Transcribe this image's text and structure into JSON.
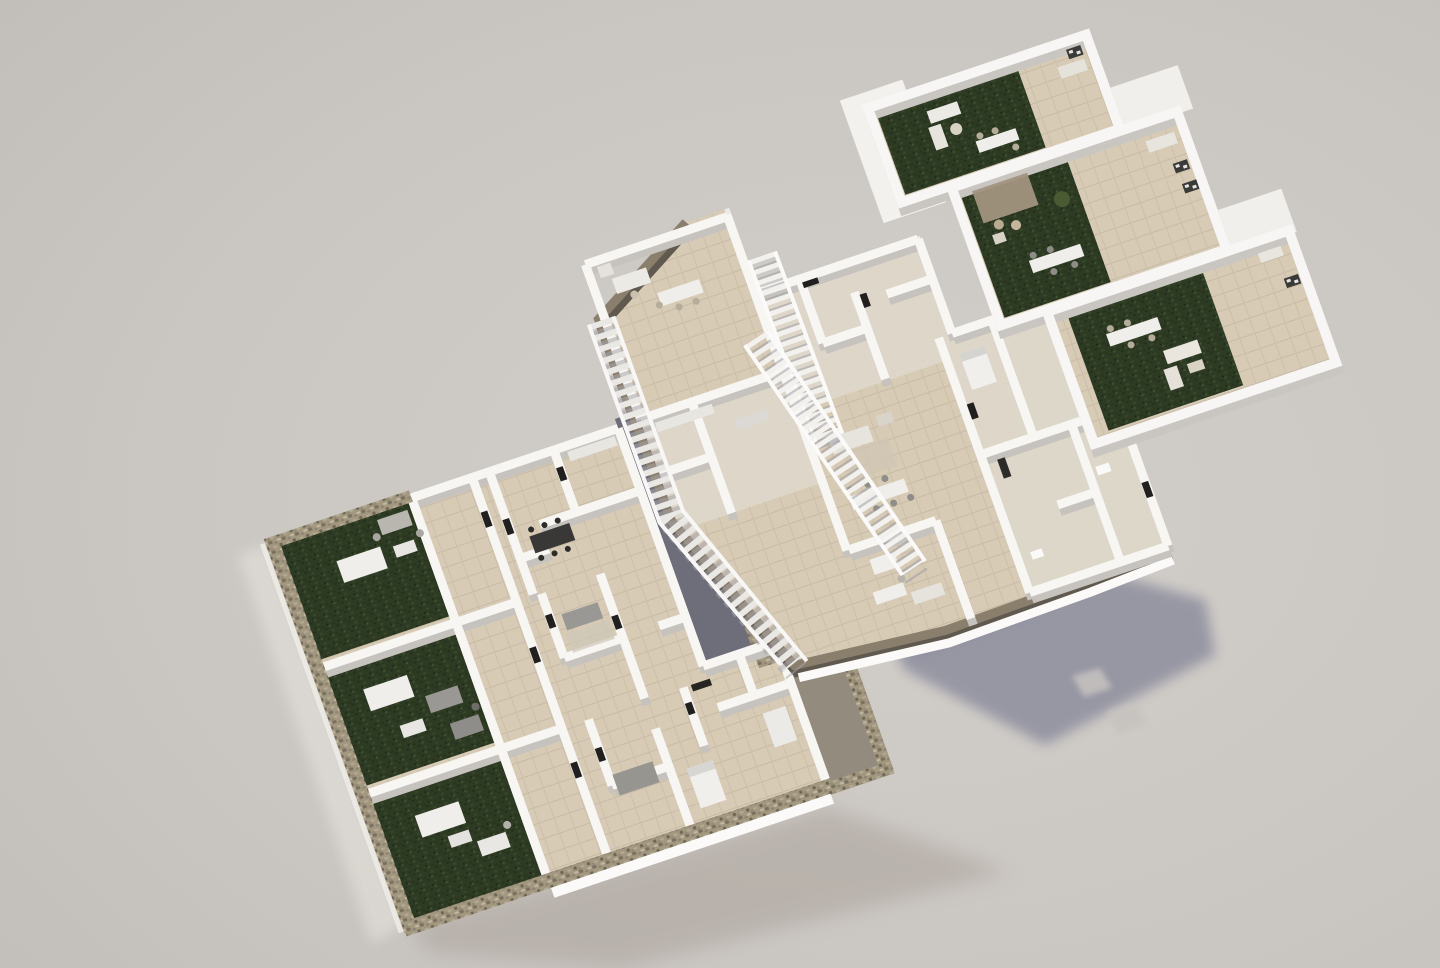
{
  "scene": {
    "kind": "architectural-3d-exploded-floorplan-render",
    "levels": [
      {
        "id": "ground-floor",
        "label": "ground floor apartments with walled private gardens"
      },
      {
        "id": "middle-floor",
        "label": "first floor apartments with terraces and open staircases"
      },
      {
        "id": "roof-floor",
        "label": "rooftop solarium terraces with pergola and lounge furniture"
      }
    ]
  },
  "colors": {
    "background_center": "#d2cec9",
    "background_edge": "#c1bdb9",
    "cast_shadow": "#8b8c9d",
    "soft_shadow": "#a89f97",
    "grass": "#2e3b24",
    "tile": "#d7cbb6",
    "tile_line": "#c7bba5",
    "stone": "#a2977f",
    "wall_white": "#f7f6f3",
    "wall_shadow": "#c6c2bd",
    "trim_brown": "#8a7e6d",
    "trim_brown_dark": "#60594f",
    "courtyard": "#6e6e7a",
    "walkway": "#938b7e",
    "pergola": "#a2947f",
    "sofa_gray": "#9a9894",
    "furniture_dark": "#3a3836",
    "furniture_white": "#efeeea"
  }
}
